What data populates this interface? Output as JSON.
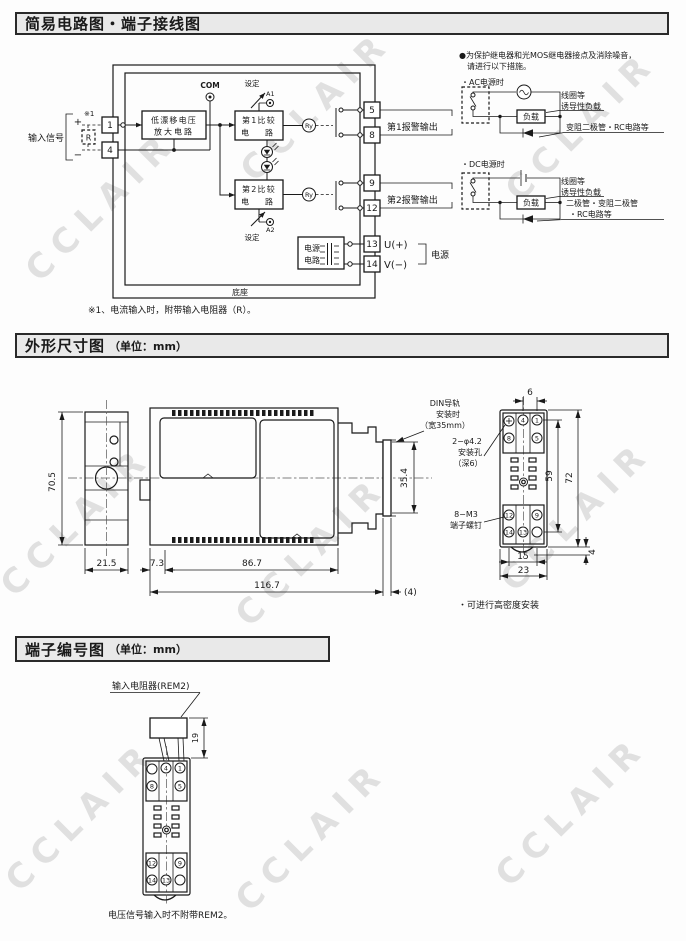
{
  "watermark": {
    "text": "CCLAIR"
  },
  "s1": {
    "title": "简易电路图・端子接线图",
    "footnote": "※1、电流输入时，附带输入电阻器（R）。",
    "c": {
      "input_signal": "输入信号",
      "plus": "+",
      "minus": "−",
      "note_ref": "※1",
      "r": "R",
      "t1": "1",
      "t4": "4",
      "t5": "5",
      "t8": "8",
      "t9": "9",
      "t12": "12",
      "t13": "13",
      "t14": "14",
      "amp1": "低漂移电压",
      "amp2": "放大电路",
      "com": "COM",
      "setting": "设定",
      "a1": "A1",
      "a2": "A2",
      "comp1": "第1比较",
      "comp2": "第2比较",
      "comp_row2": "电　路",
      "ry": "Ry",
      "alarm1": "第1报警输出",
      "alarm2": "第2报警输出",
      "u": "U(+)",
      "v": "V(−)",
      "power": "电源",
      "ps1": "电源",
      "ps2": "电路",
      "base": "底座"
    },
    "p": {
      "note1": "●为保护继电器和光MOS继电器接点及消除噪音，",
      "note2": "请进行以下措施。",
      "ac": "・AC电源时",
      "dc": "・DC电源时",
      "coil1": "线圈等",
      "coil2": "诱导性负载",
      "load": "负载",
      "ac_supp": "变阻二极管・RC电路等",
      "dc_supp1": "二极管・变阻二极管",
      "dc_supp2": "・RC电路等"
    }
  },
  "s2": {
    "title": "外形尺寸图",
    "unit": "（单位：mm）",
    "d": {
      "h705": "70.5",
      "w215": "21.5",
      "g73": "7.3",
      "w867": "86.7",
      "w1167": "116.7",
      "p4": "(4)",
      "h354": "35.4",
      "t6": "6",
      "h59": "59",
      "h72": "72",
      "w15": "15",
      "w23": "23",
      "b4": "4"
    },
    "lab": {
      "din1": "DIN导轨",
      "din2": "安装时",
      "din3": "（宽35mm）",
      "hole1": "2−φ4.2",
      "hole2": "安装孔",
      "hole3": "（深6）",
      "screw1": "8−M3",
      "screw2": "端子螺钉"
    },
    "terminals": [
      "4",
      "1",
      "8",
      "5",
      "12",
      "9",
      "14",
      "13"
    ],
    "note": "・可进行高密度安装"
  },
  "s3": {
    "title": "端子编号图",
    "unit": "（单位：mm）",
    "rem2": "输入电阻器(REM2)",
    "d19": "19",
    "terminals": [
      "4",
      "1",
      "8",
      "5",
      "12",
      "9",
      "14",
      "13"
    ],
    "note": "电压信号输入时不附带REM2。"
  }
}
